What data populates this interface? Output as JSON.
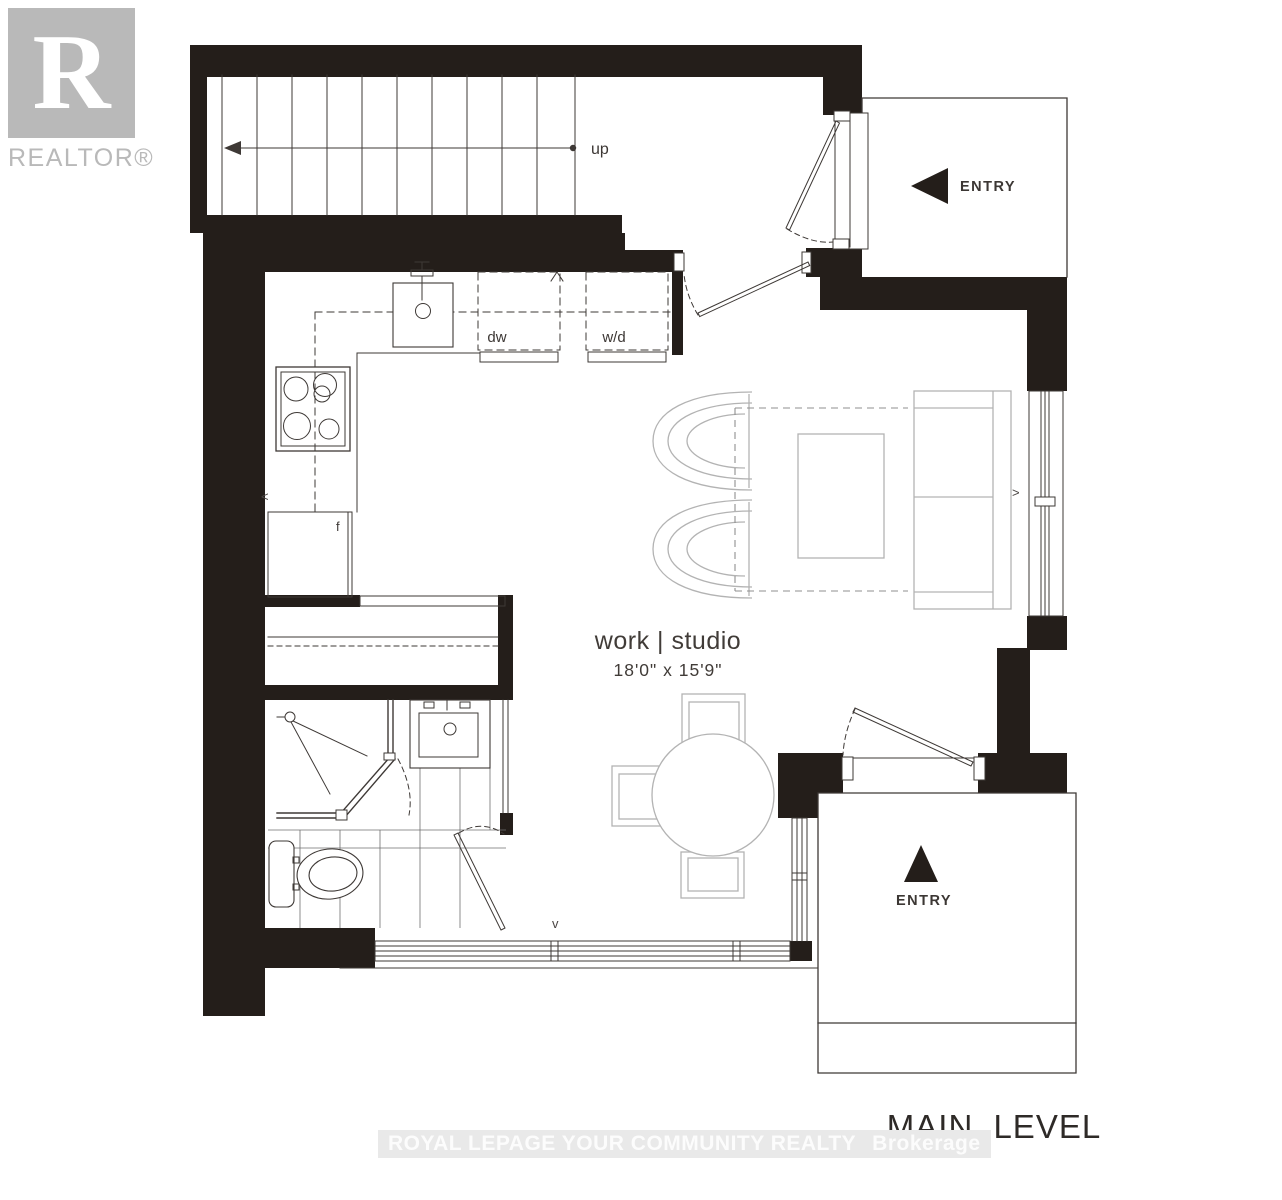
{
  "branding": {
    "logo_letter": "R",
    "logo_name": "REALTOR®"
  },
  "watermark": {
    "text": "ROYAL LEPAGE YOUR COMMUNITY REALTY",
    "suffix": "Brokerage"
  },
  "plan": {
    "level_label": "MAIN LEVEL",
    "room": {
      "name": "work | studio",
      "dimensions": "18'0\" x 15'9\""
    },
    "labels": {
      "stairs_direction": "up",
      "dishwasher": "dw",
      "washer_dryer": "w/d",
      "fridge": "f"
    },
    "entries": [
      {
        "label": "ENTRY",
        "position": "top-right"
      },
      {
        "label": "ENTRY",
        "position": "bottom-right"
      }
    ],
    "window_markers": {
      "left": "<",
      "right": ">",
      "bottom": "v"
    }
  },
  "colors": {
    "walls": "#241e1a",
    "lines": "#3e3936",
    "furniture": "#b3b3b3",
    "logo": "#b9b9b9",
    "watermark_bg": "#e9e9e9",
    "watermark_text": "#fcfcfc"
  }
}
